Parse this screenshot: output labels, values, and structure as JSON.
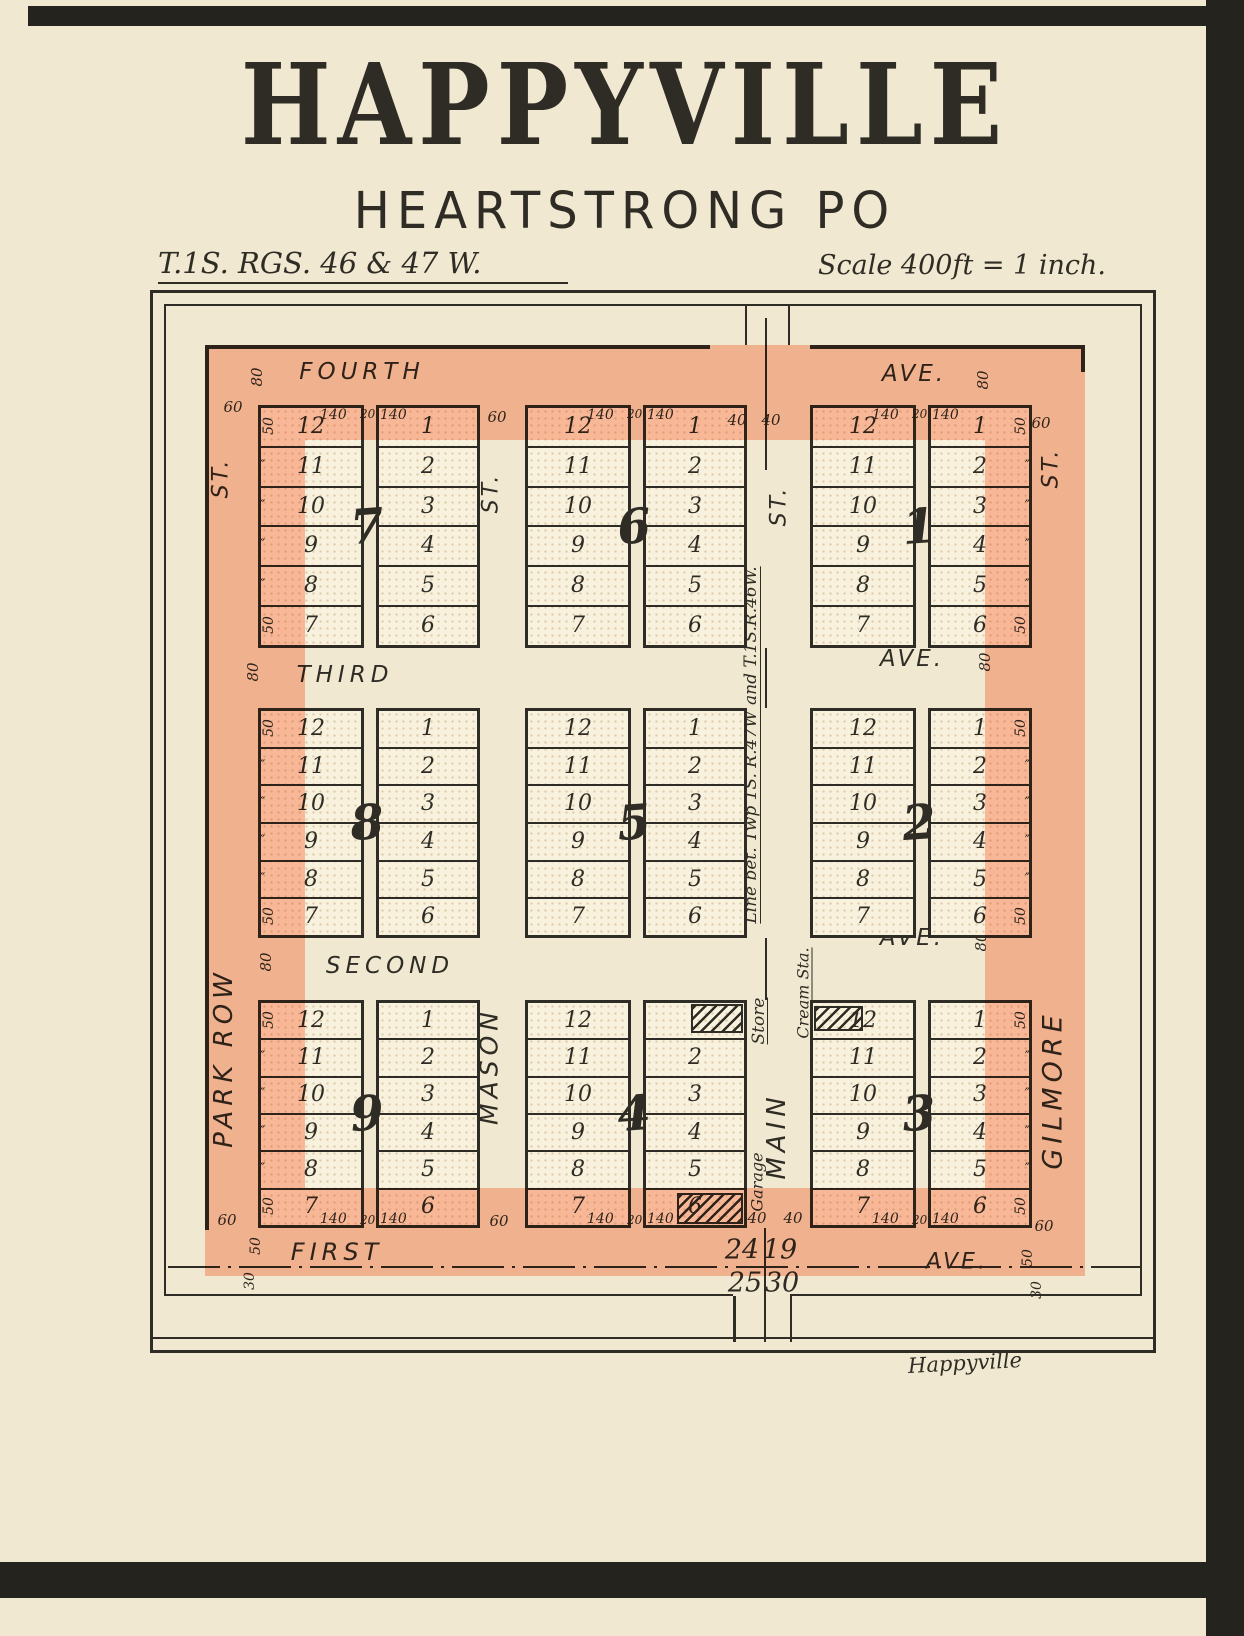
{
  "page": {
    "title": "HAPPYVILLE",
    "subtitle": "HEARTSTRONG PO",
    "township_note": "T.1S. RGS. 46 & 47 W.",
    "scale_note": "Scale 400ft = 1 inch.",
    "signature": "Happyville"
  },
  "map": {
    "avenues": {
      "fourth": {
        "name": "FOURTH",
        "ave": "AVE.",
        "width": "80"
      },
      "third": {
        "name": "THIRD",
        "ave": "AVE.",
        "width": "80"
      },
      "second": {
        "name": "SECOND",
        "ave": "AVE.",
        "width": "80"
      },
      "first": {
        "name": "FIRST",
        "ave": "AVE."
      }
    },
    "streets": {
      "park_row": {
        "name": "PARK ROW",
        "st": "ST."
      },
      "mason": {
        "name": "MASON",
        "st": "ST."
      },
      "main": {
        "name": "MAIN",
        "st": "ST."
      },
      "gilmore": {
        "name": "GILMORE",
        "st": "ST."
      }
    },
    "township_line_label": "Line bet. Twp 1S. R.47W and T.1S.R.46W.",
    "buildings": {
      "store": "Store",
      "cream_station": "Cream Sta.",
      "garage": "Garage"
    },
    "sections": {
      "nw": "24",
      "ne": "19",
      "sw": "25",
      "se": "30"
    },
    "dims": {
      "lot_front": "50",
      "lot_depth": "140",
      "alley": "20",
      "street": "60",
      "half_street": "40",
      "avenue": "80",
      "margin": "30",
      "ditto": "″"
    },
    "blocks": [
      {
        "number": "7",
        "grid": [
          0,
          0
        ],
        "left_lots": [
          "12",
          "11",
          "10",
          "9",
          "8",
          "7"
        ],
        "right_lots": [
          "1",
          "2",
          "3",
          "4",
          "5",
          "6"
        ],
        "dims": "top",
        "fifty_side": "left",
        "hatches": []
      },
      {
        "number": "6",
        "grid": [
          0,
          1
        ],
        "left_lots": [
          "12",
          "11",
          "10",
          "9",
          "8",
          "7"
        ],
        "right_lots": [
          "1",
          "2",
          "3",
          "4",
          "5",
          "6"
        ],
        "dims": "top",
        "fifty_side": null,
        "hatches": []
      },
      {
        "number": "1",
        "grid": [
          0,
          2
        ],
        "left_lots": [
          "12",
          "11",
          "10",
          "9",
          "8",
          "7"
        ],
        "right_lots": [
          "1",
          "2",
          "3",
          "4",
          "5",
          "6"
        ],
        "dims": "top",
        "fifty_side": "right",
        "hatches": []
      },
      {
        "number": "8",
        "grid": [
          1,
          0
        ],
        "left_lots": [
          "12",
          "11",
          "10",
          "9",
          "8",
          "7"
        ],
        "right_lots": [
          "1",
          "2",
          "3",
          "4",
          "5",
          "6"
        ],
        "dims": null,
        "fifty_side": "left",
        "hatches": []
      },
      {
        "number": "5",
        "grid": [
          1,
          1
        ],
        "left_lots": [
          "12",
          "11",
          "10",
          "9",
          "8",
          "7"
        ],
        "right_lots": [
          "1",
          "2",
          "3",
          "4",
          "5",
          "6"
        ],
        "dims": null,
        "fifty_side": null,
        "hatches": []
      },
      {
        "number": "2",
        "grid": [
          1,
          2
        ],
        "left_lots": [
          "12",
          "11",
          "10",
          "9",
          "8",
          "7"
        ],
        "right_lots": [
          "1",
          "2",
          "3",
          "4",
          "5",
          "6"
        ],
        "dims": null,
        "fifty_side": "right",
        "hatches": []
      },
      {
        "number": "9",
        "grid": [
          2,
          0
        ],
        "left_lots": [
          "12",
          "11",
          "10",
          "9",
          "8",
          "7"
        ],
        "right_lots": [
          "1",
          "2",
          "3",
          "4",
          "5",
          "6"
        ],
        "dims": "bottom",
        "fifty_side": "left",
        "hatches": []
      },
      {
        "number": "4",
        "grid": [
          2,
          1
        ],
        "left_lots": [
          "12",
          "11",
          "10",
          "9",
          "8",
          "7"
        ],
        "right_lots": [
          "1",
          "2",
          "3",
          "4",
          "5",
          "6"
        ],
        "dims": "bottom",
        "fifty_side": null,
        "hatches": [
          {
            "col": "right",
            "row": 0,
            "hide_number": true,
            "building": "store"
          },
          {
            "col": "right",
            "row": 5,
            "hide_number": false,
            "building": "garage"
          }
        ]
      },
      {
        "number": "3",
        "grid": [
          2,
          2
        ],
        "left_lots": [
          "12",
          "11",
          "10",
          "9",
          "8",
          "7"
        ],
        "right_lots": [
          "1",
          "2",
          "3",
          "4",
          "5",
          "6"
        ],
        "dims": "bottom",
        "fifty_side": "right",
        "hatches": [
          {
            "col": "left",
            "row": 0,
            "hide_number": false,
            "building": "cream_station"
          }
        ]
      }
    ]
  }
}
